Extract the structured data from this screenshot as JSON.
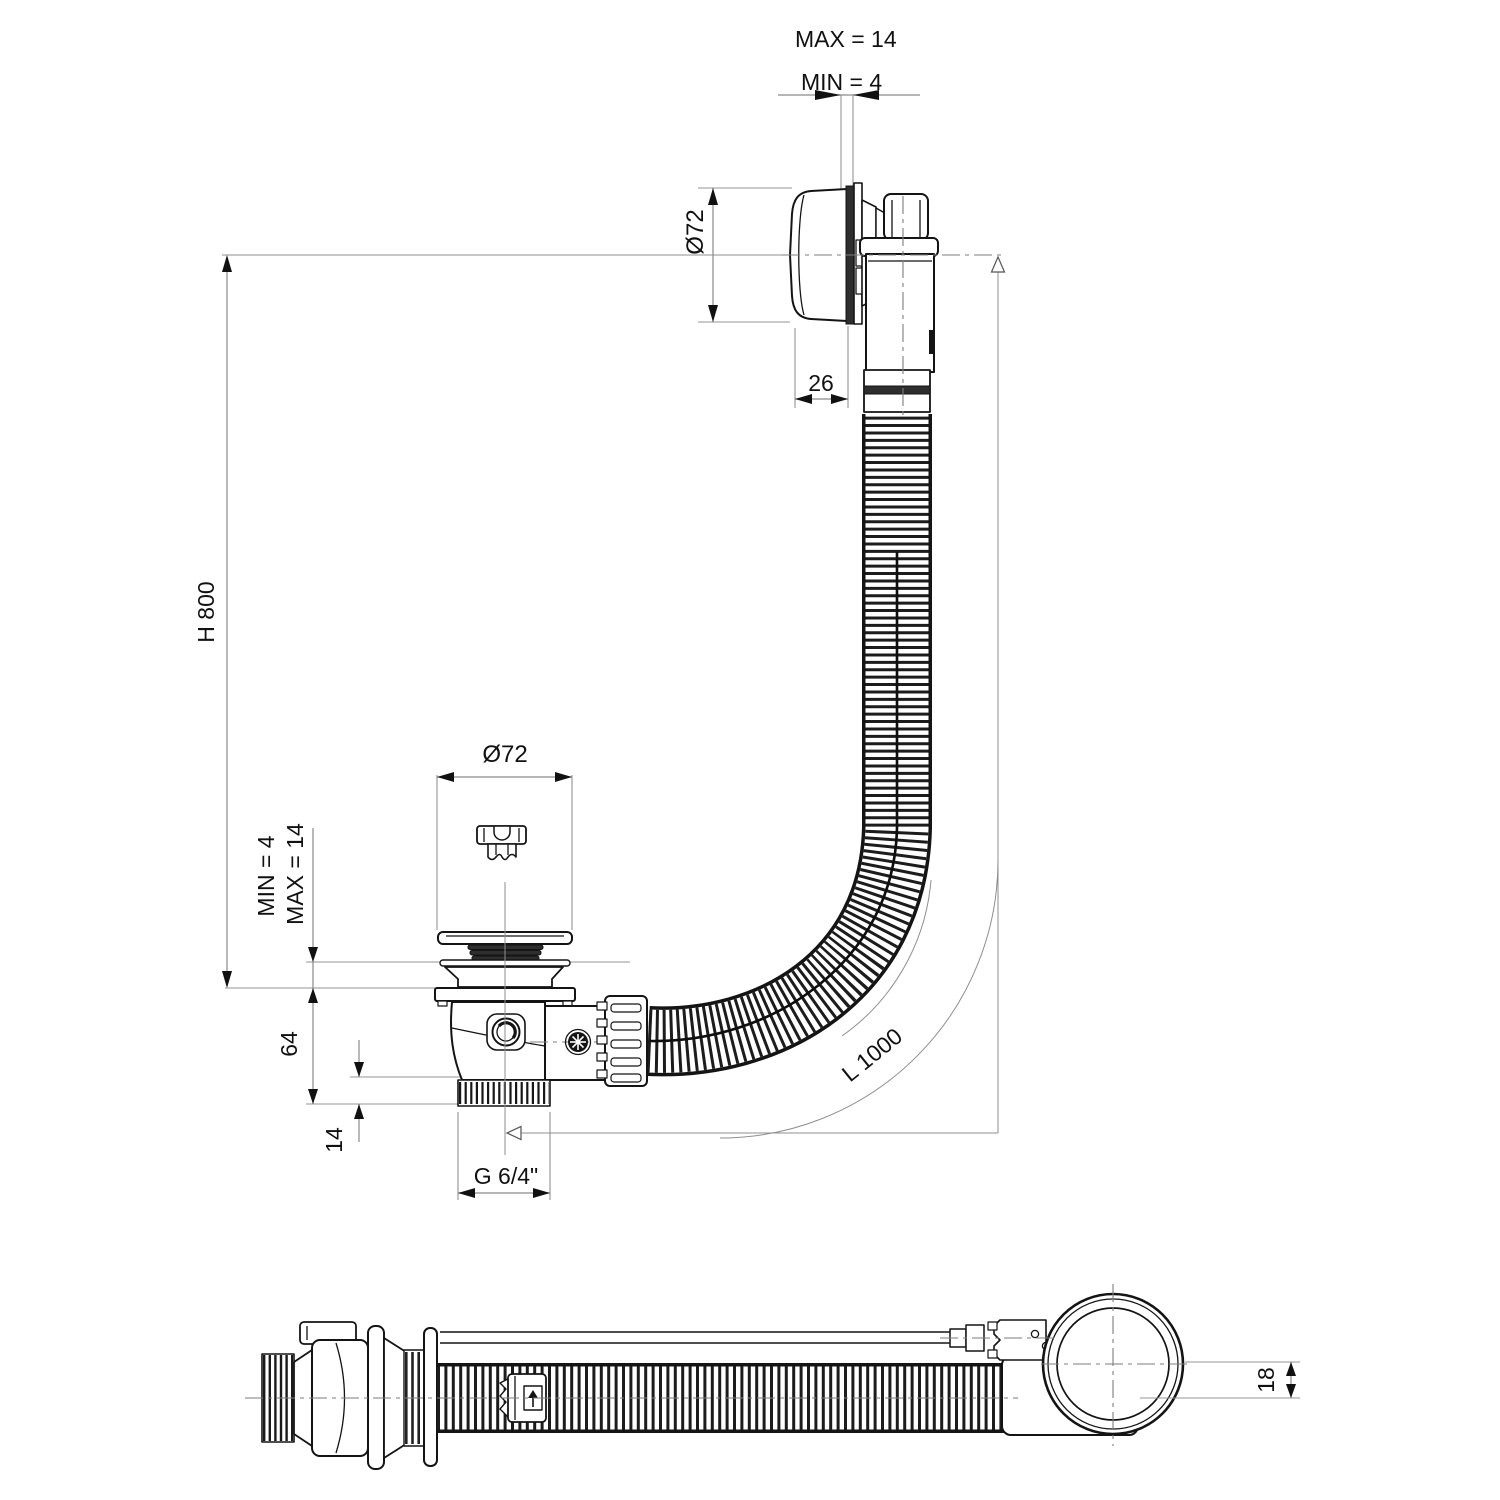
{
  "drawing": {
    "type": "technical-drawing",
    "subject": "bath-waste-and-overflow-drain-kit",
    "views": [
      "main-installed-view",
      "side-flat-view"
    ],
    "colors": {
      "background": "#ffffff",
      "part_line": "#141414",
      "dimension_line": "#8a8a8a",
      "text": "#111111"
    }
  },
  "dimensions": {
    "top_max": "MAX = 14",
    "top_min": "MIN =  4",
    "overflow_diameter": "Ø72",
    "overflow_depth": "26",
    "height": "H 800",
    "drain_diameter": "Ø72",
    "floor_min": "MIN = 4",
    "floor_max": "MAX = 14",
    "body_height": "64",
    "thread_length": "14",
    "thread_size": "G 6/4\"",
    "hose_length": "L 1000",
    "axis_offset": "18"
  }
}
